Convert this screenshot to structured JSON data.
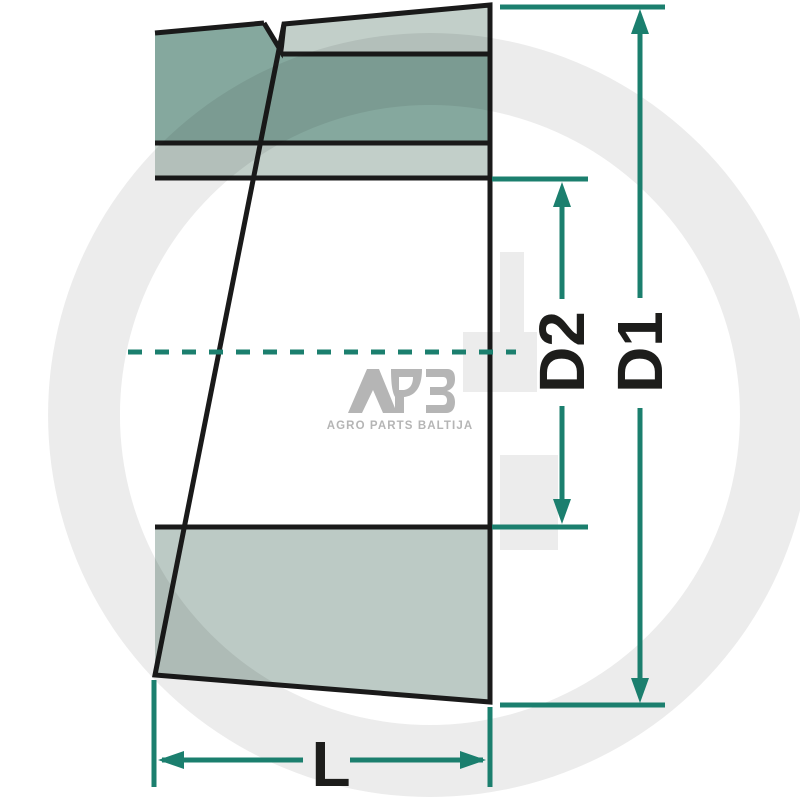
{
  "diagram": {
    "description": "Tapered split bushing cross-section drawing",
    "dimension_labels": {
      "d1": "D1",
      "d2": "D2",
      "length": "L"
    },
    "colors": {
      "dimension_line": "#1b7f6e",
      "outline": "#1a1a1a",
      "body_dark": "#85a89e",
      "body_light": "#c2cfc9",
      "body_bottom": "#bccac5",
      "body_white": "#ffffff",
      "label_text": "#1d1d1b"
    }
  },
  "watermark": {
    "logo_text": "APB",
    "logo_tagline": "AGRO PARTS BALTIJA",
    "logo_color": "#b5b5b5",
    "g_mark_color": "#ececec"
  }
}
